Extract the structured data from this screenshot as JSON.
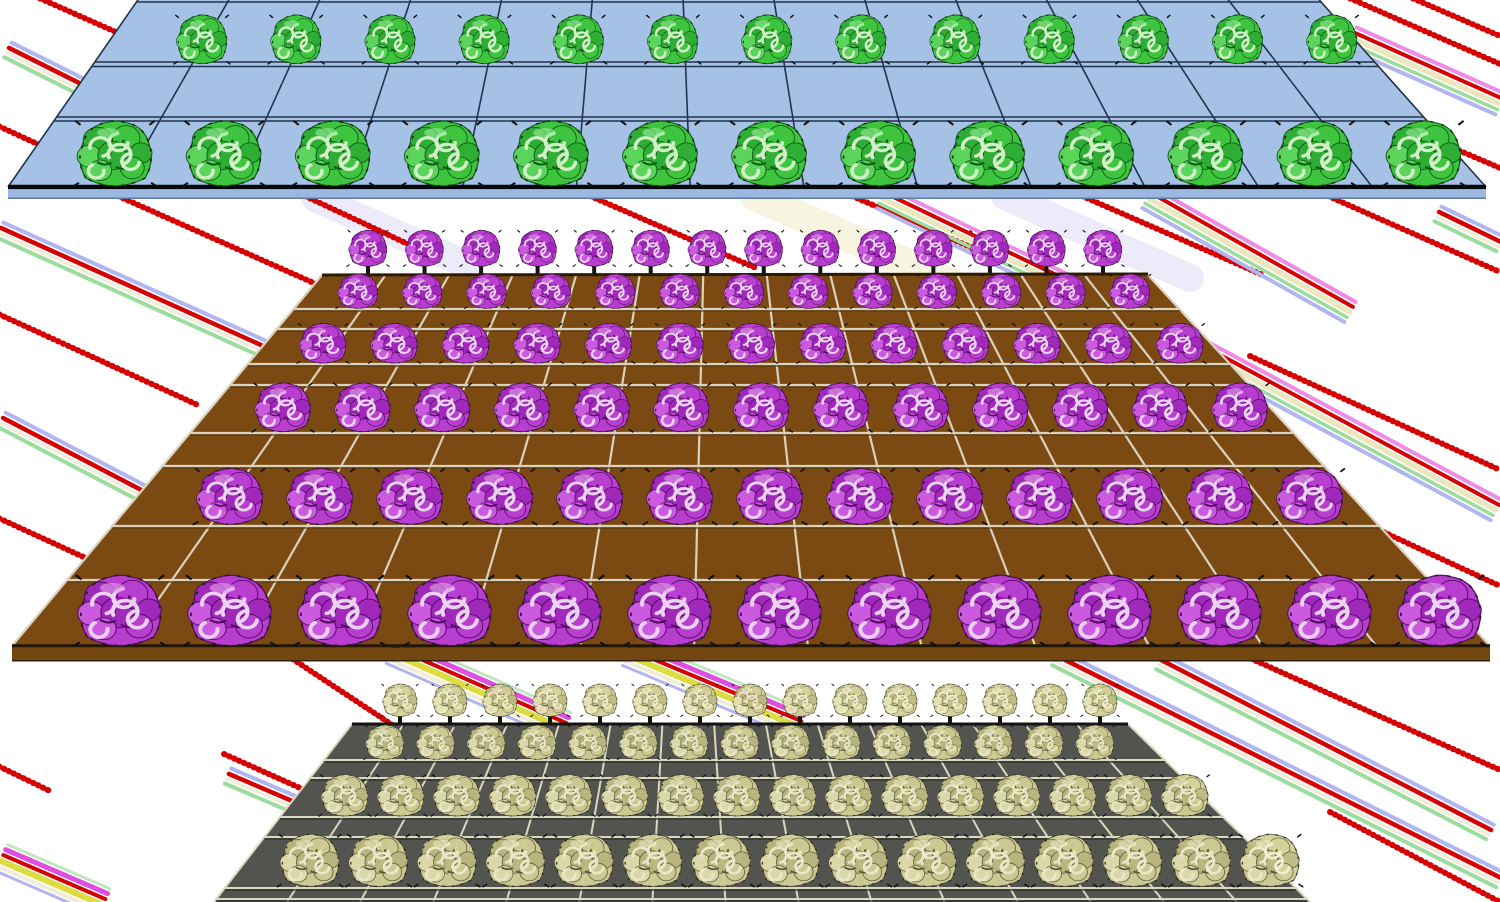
{
  "scene": {
    "description": "3D rendered farm scene: three tilted crop fields with cabbage-like plants over white background with diagonal colored streaks",
    "canvas": {
      "width": 1500,
      "height": 902,
      "background": "#ffffff"
    },
    "plant_palettes": {
      "green": {
        "p1": "#3ec43e",
        "p2": "#2fae35",
        "p3": "#5ad45a",
        "pd": "#0d5c16",
        "pl": "#d2f0c8",
        "ph": "#90e890",
        "opacity": 1
      },
      "purple": {
        "p1": "#b83ecf",
        "p2": "#a028bb",
        "p3": "#cc5ae0",
        "pd": "#570b66",
        "pl": "#ecd2f2",
        "ph": "#e09ae8",
        "opacity": 1
      },
      "olive": {
        "p1": "#d2cf96",
        "p2": "#bdbb80",
        "p3": "#e2dfae",
        "pd": "#55533a",
        "pl": "#f2efcf",
        "ph": "#efecc2",
        "opacity": 0.95
      }
    },
    "streak_styles": {
      "red": {
        "gap": 0,
        "stripes": [
          {
            "c": "#d40202",
            "w": 6,
            "dash": "0.8 4.6"
          }
        ]
      },
      "rgl": {
        "gap": 1.6,
        "stripes": [
          {
            "c": "#b2b6ee",
            "w": 4
          },
          {
            "c": "#d40202",
            "w": 4.5
          },
          {
            "c": "#f0ecd8",
            "w": 3
          },
          {
            "c": "#9cdc9c",
            "w": 4
          }
        ]
      },
      "bundleA": {
        "gap": 1.6,
        "stripes": [
          {
            "c": "#ee8ce4",
            "w": 4
          },
          {
            "c": "#d40202",
            "w": 4
          },
          {
            "c": "#ece6bc",
            "w": 5
          },
          {
            "c": "#9cdc9c",
            "w": 3.5
          },
          {
            "c": "#b2b6ee",
            "w": 4
          }
        ]
      },
      "bundleB": {
        "gap": 1.4,
        "stripes": [
          {
            "c": "#bfe8bf",
            "w": 3
          },
          {
            "c": "#e04ee0",
            "w": 5
          },
          {
            "c": "#d40202",
            "w": 4
          },
          {
            "c": "#dcdc3e",
            "w": 6
          },
          {
            "c": "#f0ecd8",
            "w": 4
          },
          {
            "c": "#b2b6ee",
            "w": 3
          }
        ]
      },
      "haloY": {
        "gap": 0,
        "stripes": [
          {
            "c": "#f0ecc2",
            "w": 30,
            "o": 0.5
          }
        ]
      },
      "haloL": {
        "gap": 0,
        "stripes": [
          {
            "c": "#dcd8f4",
            "w": 28,
            "o": 0.5
          }
        ]
      }
    },
    "streaks": [
      {
        "type": "haloY",
        "x1": 755,
        "y1": 196,
        "x2": 990,
        "y2": 300
      },
      {
        "type": "haloL",
        "x1": 1005,
        "y1": 196,
        "x2": 1190,
        "y2": 278
      },
      {
        "type": "haloL",
        "x1": 315,
        "y1": 198,
        "x2": 470,
        "y2": 266
      },
      {
        "type": "red",
        "x1": 30,
        "y1": -6,
        "x2": 152,
        "y2": 48
      },
      {
        "type": "rgl",
        "x1": 8,
        "y1": 50,
        "x2": 102,
        "y2": 97
      },
      {
        "type": "red",
        "x1": -6,
        "y1": 124,
        "x2": 44,
        "y2": 147
      },
      {
        "type": "red",
        "x1": 1398,
        "y1": -8,
        "x2": 1500,
        "y2": 36
      },
      {
        "type": "red",
        "x1": 1340,
        "y1": -6,
        "x2": 1500,
        "y2": 64
      },
      {
        "type": "bundleA",
        "x1": 1352,
        "y1": 38,
        "x2": 1500,
        "y2": 104
      },
      {
        "type": "red",
        "x1": 1444,
        "y1": 144,
        "x2": 1500,
        "y2": 168
      },
      {
        "type": "rgl",
        "x1": 1438,
        "y1": 214,
        "x2": 1500,
        "y2": 244
      },
      {
        "type": "red",
        "x1": 118,
        "y1": 196,
        "x2": 334,
        "y2": 292
      },
      {
        "type": "rgl",
        "x1": 0,
        "y1": 230,
        "x2": 262,
        "y2": 348
      },
      {
        "type": "red",
        "x1": -6,
        "y1": 312,
        "x2": 200,
        "y2": 406
      },
      {
        "type": "rgl",
        "x1": 2,
        "y1": 420,
        "x2": 190,
        "y2": 518
      },
      {
        "type": "red",
        "x1": -6,
        "y1": 516,
        "x2": 90,
        "y2": 560
      },
      {
        "type": "red",
        "x1": 305,
        "y1": 196,
        "x2": 425,
        "y2": 252
      },
      {
        "type": "red",
        "x1": 590,
        "y1": 196,
        "x2": 756,
        "y2": 268
      },
      {
        "type": "red",
        "x1": 852,
        "y1": 196,
        "x2": 1005,
        "y2": 262
      },
      {
        "type": "bundleA",
        "x1": 882,
        "y1": 198,
        "x2": 1095,
        "y2": 300
      },
      {
        "type": "red",
        "x1": 1082,
        "y1": 196,
        "x2": 1265,
        "y2": 276
      },
      {
        "type": "bundleA",
        "x1": 1148,
        "y1": 198,
        "x2": 1350,
        "y2": 312
      },
      {
        "type": "red",
        "x1": 1328,
        "y1": 196,
        "x2": 1500,
        "y2": 272
      },
      {
        "type": "bundleA",
        "x1": 1180,
        "y1": 340,
        "x2": 1496,
        "y2": 510
      },
      {
        "type": "red",
        "x1": 1250,
        "y1": 356,
        "x2": 1500,
        "y2": 470
      },
      {
        "type": "red",
        "x1": 1310,
        "y1": 498,
        "x2": 1500,
        "y2": 586
      },
      {
        "type": "red",
        "x1": 288,
        "y1": 656,
        "x2": 400,
        "y2": 730
      },
      {
        "type": "bundleB",
        "x1": 392,
        "y1": 650,
        "x2": 565,
        "y2": 726
      },
      {
        "type": "bundleB",
        "x1": 628,
        "y1": 652,
        "x2": 800,
        "y2": 724
      },
      {
        "type": "rgl",
        "x1": 1160,
        "y1": 662,
        "x2": 1490,
        "y2": 832
      },
      {
        "type": "rgl",
        "x1": 1056,
        "y1": 658,
        "x2": 1500,
        "y2": 880
      },
      {
        "type": "red",
        "x1": 1236,
        "y1": 652,
        "x2": 1500,
        "y2": 770
      },
      {
        "type": "red",
        "x1": 1330,
        "y1": 812,
        "x2": 1500,
        "y2": 902
      },
      {
        "type": "red",
        "x1": -6,
        "y1": 764,
        "x2": 52,
        "y2": 792
      },
      {
        "type": "bundleB",
        "x1": 2,
        "y1": 858,
        "x2": 104,
        "y2": 902
      },
      {
        "type": "red",
        "x1": 224,
        "y1": 754,
        "x2": 318,
        "y2": 796
      },
      {
        "type": "rgl",
        "x1": 228,
        "y1": 776,
        "x2": 312,
        "y2": 812
      }
    ],
    "fields": [
      {
        "name": "back-field",
        "crop": "green",
        "surface": "#a6c1e6",
        "line_color": "#22344c",
        "line_w": 1.6,
        "corners": {
          "tl": [
            142,
            -6
          ],
          "tr": [
            1314,
            -6
          ],
          "bl": [
            8,
            187
          ],
          "br": [
            1486,
            187
          ]
        },
        "cols": 13,
        "hlines": [
          2,
          62,
          66.5,
          117,
          121
        ],
        "bottom": {
          "edge_color": "#05080c",
          "edge_w": 4.5,
          "side_color": "#9cb8e0",
          "side_h": 9,
          "side_border": "#5e7ca0"
        },
        "plant_rows": [
          {
            "base": 66,
            "count": 13,
            "x0": 202,
            "x1": 1332,
            "w": 58,
            "h": 54
          },
          {
            "base": 189,
            "count": 13,
            "x0": 115,
            "x1": 1424,
            "w": 86,
            "h": 72
          }
        ]
      },
      {
        "name": "middle-field",
        "crop": "purple",
        "surface": "#7b4a12",
        "line_color": "#dbd2be",
        "line_w": 2.2,
        "hline_shadow": "#5a3a10",
        "corners": {
          "tl": [
            322,
            275
          ],
          "tr": [
            1148,
            274
          ],
          "bl": [
            12,
            646
          ],
          "br": [
            1490,
            646
          ]
        },
        "cols": 13,
        "top_edge": {
          "color": "#2b1c06",
          "w": 3
        },
        "hlines": [
          309,
          329,
          364,
          385,
          433,
          466,
          526,
          580
        ],
        "bottom": {
          "edge_color": "#241604",
          "edge_w": 3.5,
          "side_color": "#744710",
          "side_h": 13,
          "side_border": "#33200a"
        },
        "plant_rows": [
          {
            "base": 268,
            "count": 14,
            "x0": 368,
            "x1": 1103,
            "w": 44,
            "h": 40,
            "behind": true,
            "stem": true
          },
          {
            "base": 310,
            "count": 13,
            "x0": 358,
            "x1": 1130,
            "w": 46,
            "h": 38
          },
          {
            "base": 365,
            "count": 13,
            "x0": 323,
            "x1": 1180,
            "w": 54,
            "h": 44
          },
          {
            "base": 434,
            "count": 13,
            "x0": 283,
            "x1": 1240,
            "w": 64,
            "h": 54
          },
          {
            "base": 527,
            "count": 13,
            "x0": 230,
            "x1": 1310,
            "w": 76,
            "h": 62
          },
          {
            "base": 649,
            "count": 13,
            "x0": 120,
            "x1": 1440,
            "w": 96,
            "h": 78
          }
        ]
      },
      {
        "name": "front-field",
        "crop": "olive",
        "surface": "#535350",
        "line_color": "#d9d9bf",
        "line_w": 2,
        "hline_shadow": "#2e2e28",
        "corners": {
          "tl": [
            352,
            724
          ],
          "tr": [
            1128,
            724
          ],
          "bl": [
            214,
            902
          ],
          "br": [
            1310,
            902
          ]
        },
        "cols": 15,
        "top_edge": {
          "color": "#141414",
          "w": 3
        },
        "hlines": [
          760,
          778,
          817,
          837,
          888,
          899
        ],
        "plant_rows": [
          {
            "base": 718,
            "count": 15,
            "x0": 400,
            "x1": 1100,
            "w": 40,
            "h": 36,
            "behind": true,
            "stem": true
          },
          {
            "base": 761,
            "count": 15,
            "x0": 385,
            "x1": 1095,
            "w": 44,
            "h": 38
          },
          {
            "base": 818,
            "count": 16,
            "x0": 345,
            "x1": 1185,
            "w": 54,
            "h": 46
          },
          {
            "base": 889,
            "count": 15,
            "x0": 310,
            "x1": 1270,
            "w": 68,
            "h": 58
          }
        ]
      }
    ]
  }
}
